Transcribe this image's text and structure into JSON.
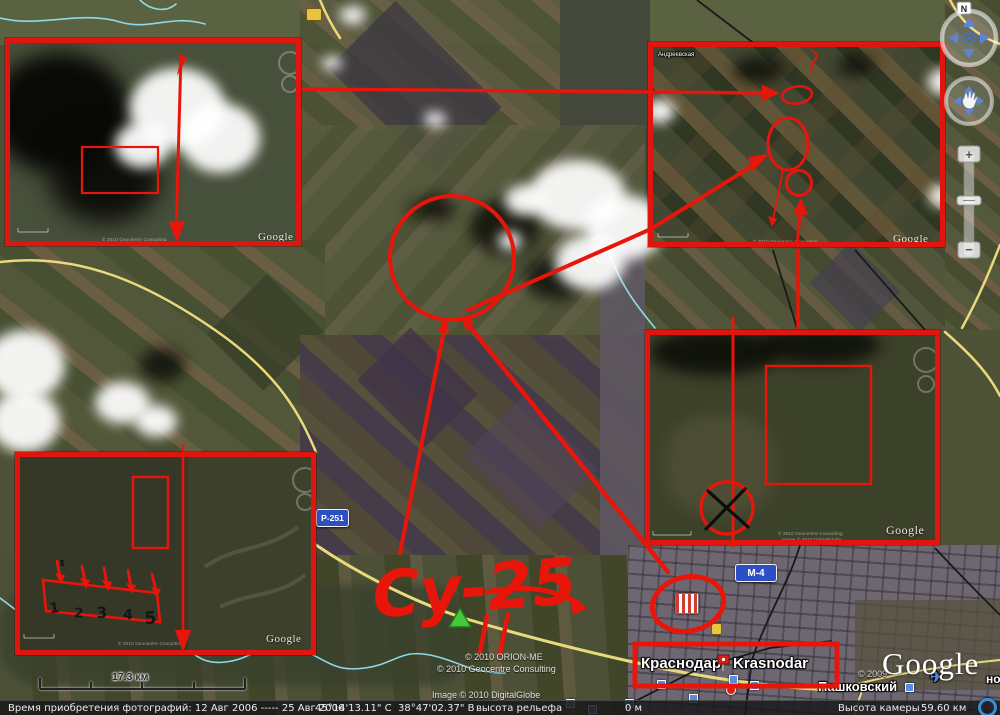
{
  "status_bar": {
    "imagery_date": "Время приобретения фотографий:  12 Авг 2006 ----- 25 Авг 2006",
    "latitude": "45°14'13.11\" С",
    "longitude": "38°47'02.37\" В",
    "elevation_label": "высота рельефа",
    "elevation_value": "0 м",
    "camera_label": "Высота камеры",
    "camera_value": "59.60 км"
  },
  "scale_bar": {
    "label": "17.3 км"
  },
  "map_labels": {
    "city_ru": "Краснодар",
    "city_en": "Krasnodar",
    "suburb": "Пашковский",
    "road_m4": "М-4",
    "road_p251": "Р-251",
    "clipped_label": "но",
    "inset_village": "Андреевская"
  },
  "annotations": {
    "aircraft_label": "Су-25",
    "row_numbers": [
      "1",
      "2",
      "3",
      "4",
      "5"
    ]
  },
  "watermarks": {
    "google": "Google",
    "google_year": "© 2009",
    "copyright_line1": "© 2010 ORION-ME",
    "copyright_line2": "© 2010 Geocentre Consulting",
    "copyright_line3": "Image © 2010 DigitalGlobe"
  },
  "nav": {
    "north": "N",
    "zoom_in": "+",
    "zoom_out": "−"
  },
  "icons": {
    "airplane": "✈"
  },
  "colors": {
    "annotation_red": "#e8150a",
    "road_yellow": "#e9da7b",
    "river_cyan": "#8fd9e8",
    "shield_blue": "#2e4fc4"
  }
}
